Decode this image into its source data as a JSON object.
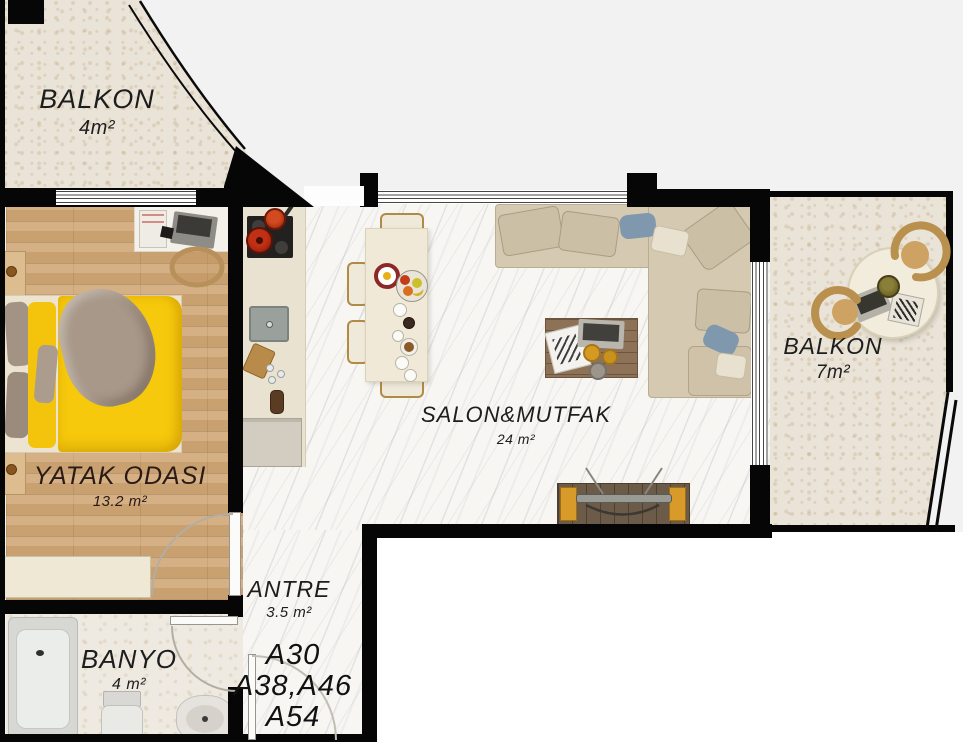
{
  "rooms": {
    "balcony_top": {
      "label": "BALKON",
      "area": "4m²"
    },
    "bedroom": {
      "label": "YATAK ODASI",
      "area": "13.2 m²"
    },
    "living_kitchen": {
      "label": "SALON&MUTFAK",
      "area": "24 m²"
    },
    "balcony_right": {
      "label": "BALKON",
      "area": "7m²"
    },
    "hallway": {
      "label": "ANTRE",
      "area": "3.5 m²"
    },
    "bathroom": {
      "label": "BANYO",
      "area": "4 m²"
    }
  },
  "units": {
    "line1": "A30",
    "line2": "A38,A46",
    "line3": "A54"
  },
  "colors": {
    "wall": "#060606",
    "background": "#f2f2f2",
    "marble_floor": "#f7f6f3",
    "wood_floor": "#c9a070",
    "stone_floor": "#eae4d8",
    "bed_blanket_yellow": "#f6c70a",
    "sofa_beige": "#d4c8af",
    "pillow_blue": "#7f98ad",
    "chair_rattan": "#b9904e"
  }
}
